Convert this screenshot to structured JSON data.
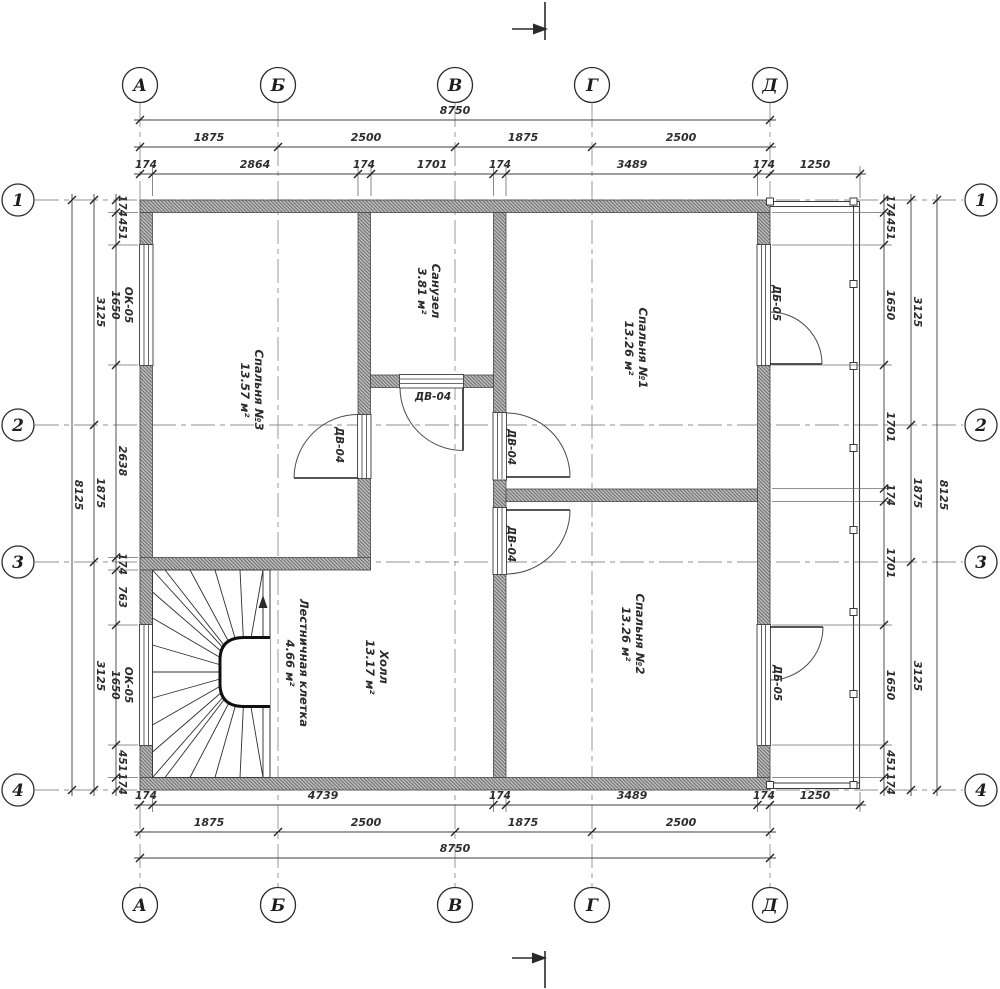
{
  "axes": {
    "cols": [
      "А",
      "Б",
      "В",
      "Г",
      "Д"
    ],
    "rows": [
      "1",
      "2",
      "3",
      "4"
    ]
  },
  "dims": {
    "top_total": "8750",
    "top_axes": [
      "1875",
      "2500",
      "1875",
      "2500"
    ],
    "top_detail": [
      "174",
      "2864",
      "174",
      "1701",
      "174",
      "3489",
      "174",
      "1250"
    ],
    "bottom_detail": [
      "174",
      "4739",
      "174",
      "3489",
      "174",
      "1250"
    ],
    "bottom_axes": [
      "1875",
      "2500",
      "1875",
      "2500"
    ],
    "bottom_total": "8750",
    "left_total": "8125",
    "left_axes": [
      "3125",
      "1875",
      "3125"
    ],
    "left_detail": [
      "174",
      "451",
      "2638",
      "174",
      "763",
      "451",
      "174"
    ],
    "right_detail": [
      "174",
      "451",
      "1650",
      "1701",
      "174",
      "1701",
      "1650",
      "451",
      "174"
    ],
    "right_axes": [
      "3125",
      "1875",
      "3125"
    ],
    "right_total": "8125"
  },
  "windows": {
    "mark": "ОК-05",
    "dim": "1650"
  },
  "rooms": {
    "bedroom3": {
      "name": "Спальня №3",
      "area": "13.57 м²"
    },
    "bathroom": {
      "name": "Санузел",
      "area": "3.81 м²"
    },
    "bedroom1": {
      "name": "Спальня №1",
      "area": "13.26 м²"
    },
    "bedroom2": {
      "name": "Спальня №2",
      "area": "13.26 м²"
    },
    "hall": {
      "name": "Холл",
      "area": "13.17 м²"
    },
    "stairwell": {
      "name": "Лестничная клетка",
      "area": "4.66 м²"
    }
  },
  "doors": {
    "interior": "ДВ-04",
    "balcony": "ДБ-05"
  }
}
